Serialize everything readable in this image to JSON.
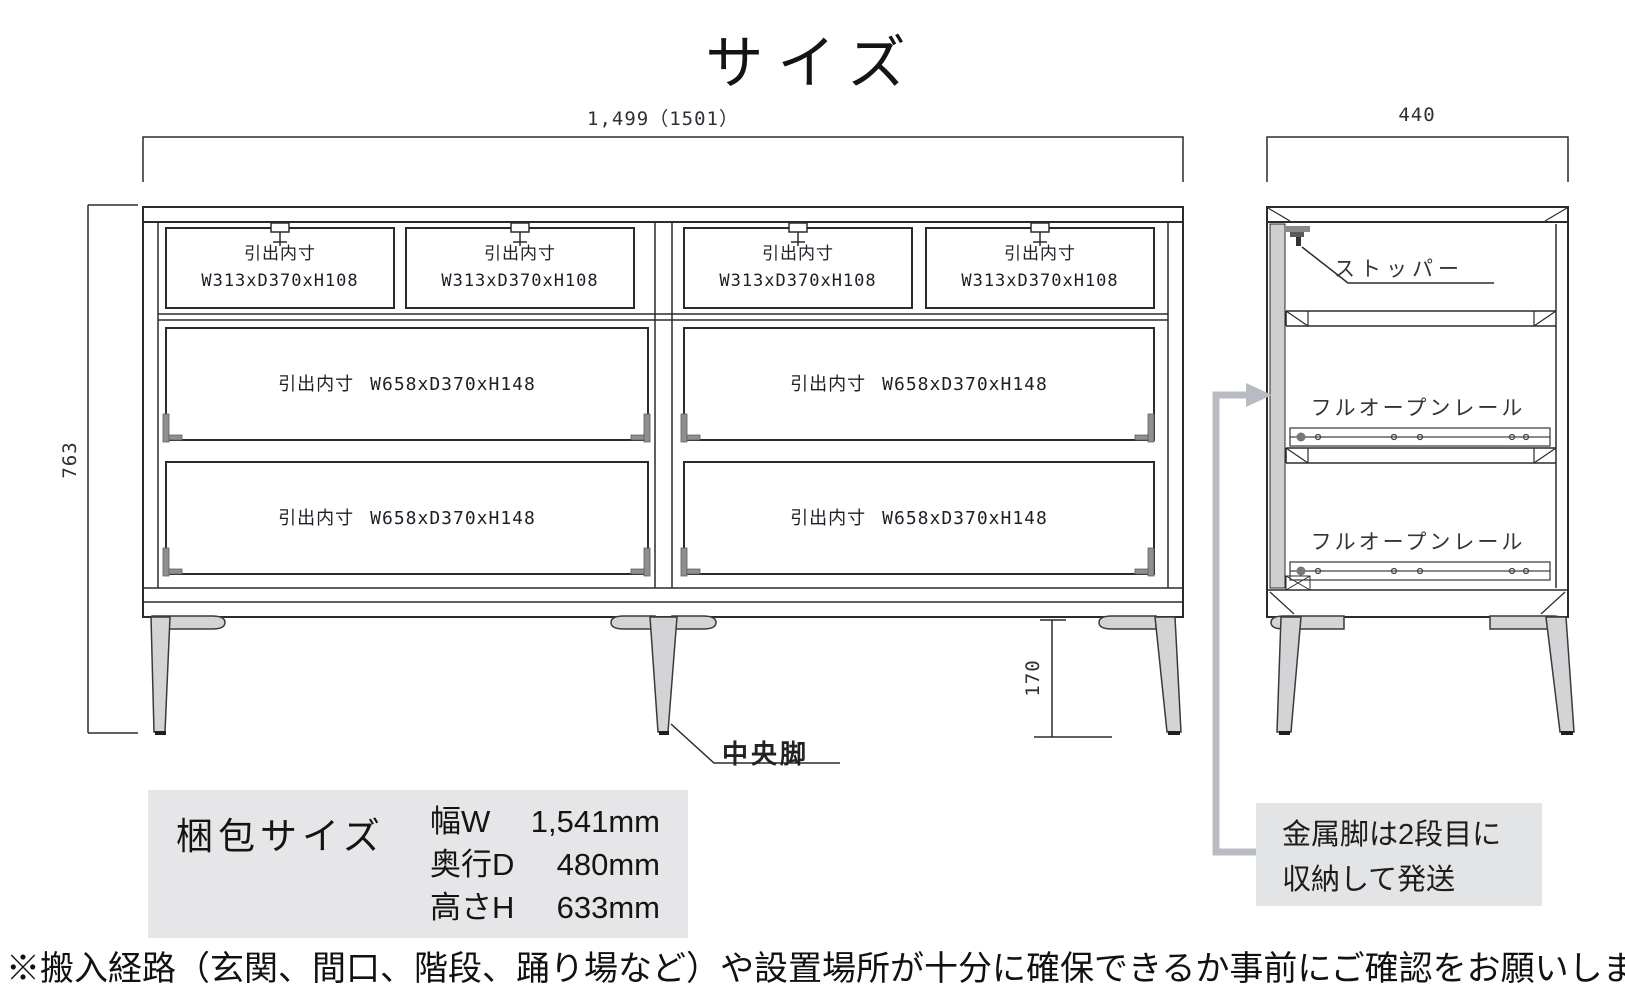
{
  "page": {
    "title": "サイズ",
    "footer_note": "※搬入経路（玄関、間口、階段、踊り場など）や設置場所が十分に確保できるか事前にご確認をお願いします。"
  },
  "front_view": {
    "width_dim": "1,499（1501）",
    "height_dim": "763",
    "leg_height_dim": "170",
    "center_leg_label": "中央脚",
    "small_drawers": [
      {
        "name": "引出内寸",
        "size": "W313xD370xH108"
      },
      {
        "name": "引出内寸",
        "size": "W313xD370xH108"
      },
      {
        "name": "引出内寸",
        "size": "W313xD370xH108"
      },
      {
        "name": "引出内寸",
        "size": "W313xD370xH108"
      }
    ],
    "large_drawers": [
      {
        "name": "引出内寸",
        "size": "W658xD370xH148"
      },
      {
        "name": "引出内寸",
        "size": "W658xD370xH148"
      },
      {
        "name": "引出内寸",
        "size": "W658xD370xH148"
      },
      {
        "name": "引出内寸",
        "size": "W658xD370xH148"
      }
    ]
  },
  "side_view": {
    "depth_dim": "440",
    "stopper_label": "ストッパー",
    "rail_labels": [
      "フルオープンレール",
      "フルオープンレール"
    ],
    "shipping_note": {
      "line1": "金属脚は2段目に",
      "line2": "収納して発送"
    }
  },
  "packing": {
    "title": "梱包サイズ",
    "rows": [
      {
        "label": "幅W",
        "value": "1,541mm"
      },
      {
        "label": "奥行D",
        "value": "480mm"
      },
      {
        "label": "高さH",
        "value": "633mm"
      }
    ]
  },
  "colors": {
    "line": "#2b2b2b",
    "leg_gray": "#d4d4d6",
    "box_gray": "#e6e6e8",
    "arrow_gray": "#b8bcc2"
  }
}
